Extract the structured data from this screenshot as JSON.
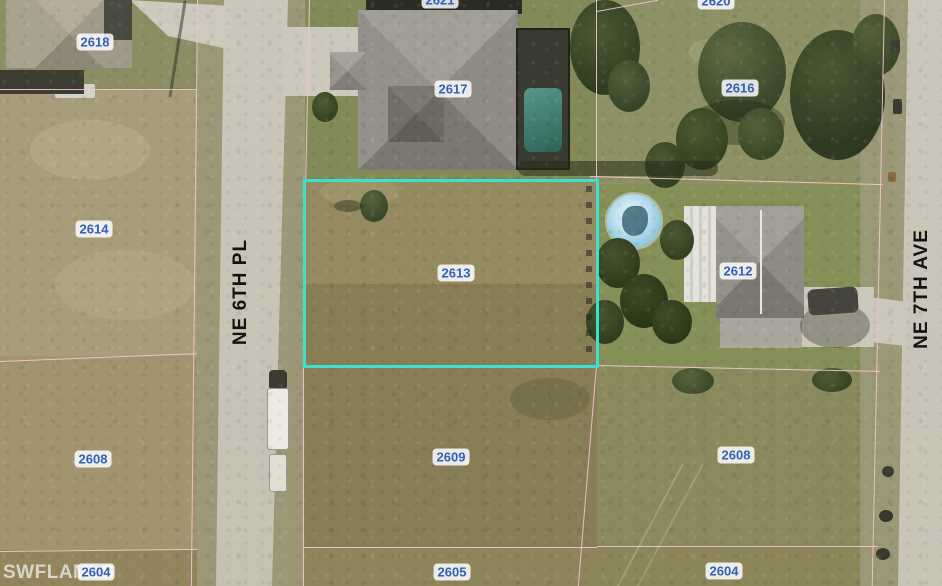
{
  "map": {
    "type": "aerial-parcel-map",
    "watermark": "SWFLAMLS",
    "streets": [
      {
        "name": "NE 6TH PL"
      },
      {
        "name": "NE 7TH AVE"
      }
    ],
    "parcels": [
      {
        "label": "2618"
      },
      {
        "label": "2621"
      },
      {
        "label": "2620"
      },
      {
        "label": "2617"
      },
      {
        "label": "2616"
      },
      {
        "label": "2614"
      },
      {
        "label": "2613",
        "highlighted": true
      },
      {
        "label": "2612"
      },
      {
        "label": "2608"
      },
      {
        "label": "2609"
      },
      {
        "label": "2608"
      },
      {
        "label": "2604"
      },
      {
        "label": "2605"
      },
      {
        "label": "2604"
      }
    ],
    "highlight": {
      "parcel": "2613",
      "color": "#3be1cf"
    },
    "boundary_color": "#f4c3cf",
    "label_text_color": "#2f62b8"
  }
}
